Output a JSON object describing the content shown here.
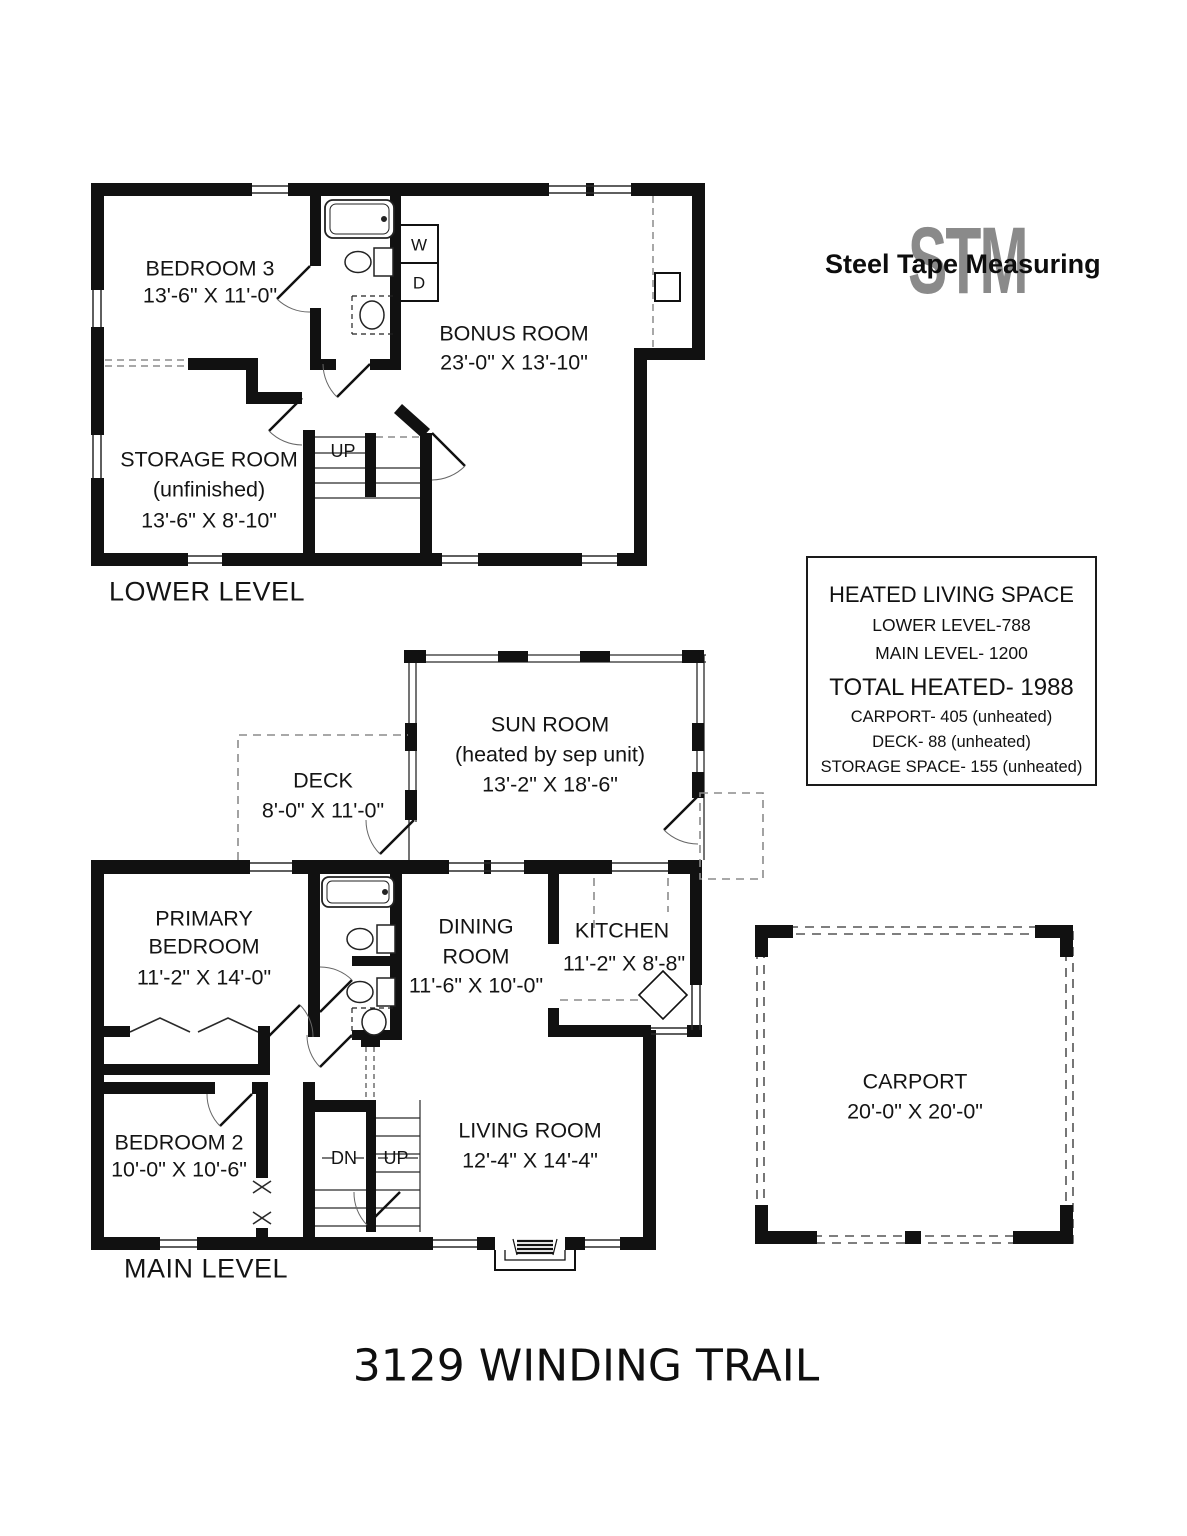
{
  "logo": {
    "monogram": "STM",
    "name": "Steel Tape Measuring"
  },
  "title": "3129 WINDING TRAIL",
  "levels": {
    "lower": {
      "caption": "LOWER LEVEL",
      "rooms": {
        "bedroom3": {
          "name": "BEDROOM 3",
          "dims": "13'-6\" X 11'-0\""
        },
        "bonus": {
          "name": "BONUS ROOM",
          "dims": "23'-0\" X 13'-10\""
        },
        "storage": {
          "name": "STORAGE ROOM",
          "sub": "(unfinished)",
          "dims": "13'-6\" X 8'-10\""
        }
      },
      "stairs": {
        "up": "UP"
      },
      "laundry": {
        "washer": "W",
        "dryer": "D"
      }
    },
    "main": {
      "caption": "MAIN LEVEL",
      "rooms": {
        "sunroom": {
          "name": "SUN ROOM",
          "sub": "(heated by sep unit)",
          "dims": "13'-2\" X 18'-6\""
        },
        "deck": {
          "name": "DECK",
          "dims": "8'-0\" X 11'-0\""
        },
        "primary": {
          "name1": "PRIMARY",
          "name2": "BEDROOM",
          "dims": "11'-2\" X 14'-0\""
        },
        "dining": {
          "name1": "DINING",
          "name2": "ROOM",
          "dims": "11'-6\" X 10'-0\""
        },
        "kitchen": {
          "name": "KITCHEN",
          "dims": "11'-2\" X 8'-8\""
        },
        "bedroom2": {
          "name": "BEDROOM 2",
          "dims": "10'-0\" X 10'-6\""
        },
        "living": {
          "name": "LIVING ROOM",
          "dims": "12'-4\" X 14'-4\""
        },
        "carport": {
          "name": "CARPORT",
          "dims": "20'-0\" X 20'-0\""
        }
      },
      "stairs": {
        "dn": "DN",
        "up": "UP"
      }
    }
  },
  "summary": {
    "title": "HEATED LIVING SPACE",
    "lines": [
      "LOWER LEVEL-788",
      "MAIN LEVEL- 1200",
      "TOTAL HEATED- 1988",
      "CARPORT- 405 (unheated)",
      "DECK- 88 (unheated)",
      "STORAGE SPACE- 155 (unheated)"
    ]
  },
  "colors": {
    "wall": "#111111",
    "thin_line": "#2a2a2a",
    "dashed": "#8c8c8c",
    "logo_gray": "#8a8a8a",
    "text": "#141414"
  }
}
